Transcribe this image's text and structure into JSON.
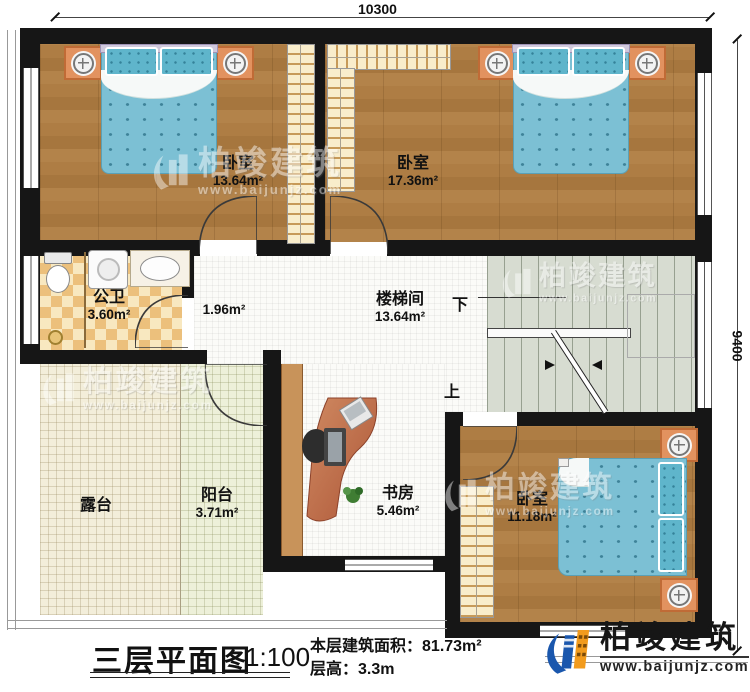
{
  "dimensions": {
    "top": "10300",
    "right": "9400"
  },
  "rooms": {
    "bedroom1": {
      "label": "卧室",
      "area": "13.64m²"
    },
    "bedroom2": {
      "label": "卧室",
      "area": "17.36m²"
    },
    "bathroom": {
      "label": "公卫",
      "area": "3.60m²"
    },
    "hallway": {
      "area": "1.96m²"
    },
    "stairwell": {
      "label": "楼梯间",
      "area": "13.64m²"
    },
    "terrace": {
      "label": "露台"
    },
    "balcony": {
      "label": "阳台",
      "area": "3.71m²"
    },
    "study": {
      "label": "书房",
      "area": "5.46m²"
    },
    "bedroom3": {
      "label": "卧室",
      "area": "11.18m²"
    }
  },
  "stairs": {
    "down": "下",
    "up": "上"
  },
  "title_block": {
    "title": "三层平面图",
    "scale": "1:100",
    "area_label": "本层建筑面积：",
    "area_value": "81.73m²",
    "height_label": "层高：",
    "height_value": "3.3m"
  },
  "brand": {
    "name": "柏竣建筑",
    "url": "www.baijunjz.com"
  },
  "colors": {
    "wall": "#161616",
    "wood_floor": "#ab7b41",
    "bed_teal": "#7cc0d4",
    "nightstand_orange": "#e2925f",
    "logo_blue": "#1a57ad",
    "logo_orange": "#f29b1d"
  }
}
